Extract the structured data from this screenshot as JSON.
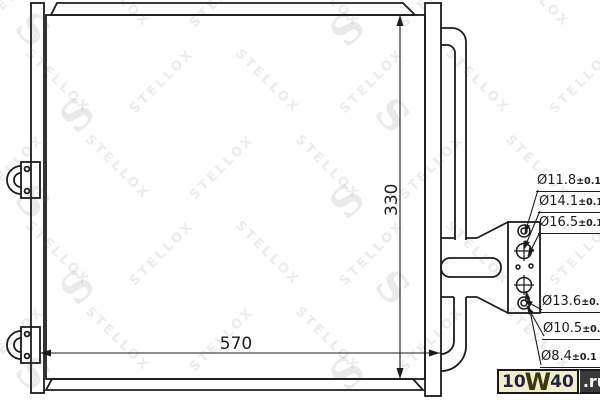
{
  "watermark": {
    "text": "STELLOX",
    "logo_letter": "S"
  },
  "diagram": {
    "part_type": "condenser-technical-drawing",
    "dim_height": "330",
    "dim_width": "570",
    "line_color": "#1c1c1c",
    "port_labels": [
      {
        "dia": "Ø11.8",
        "tol": "±0.1"
      },
      {
        "dia": "Ø14.1",
        "tol": "±0.1"
      },
      {
        "dia": "Ø16.5",
        "tol": "±0.1"
      },
      {
        "dia": "Ø13.6",
        "tol": "±0.1"
      },
      {
        "dia": "Ø10.5",
        "tol": "±0.1"
      },
      {
        "dia": "Ø8.4",
        "tol": "±0.1"
      }
    ]
  },
  "logo": {
    "p1": "10",
    "w": "W",
    "p2": "40",
    "tld": ".ru",
    "cream_bg": "#f1eecd",
    "dark_bg": "#3a3a3a"
  }
}
